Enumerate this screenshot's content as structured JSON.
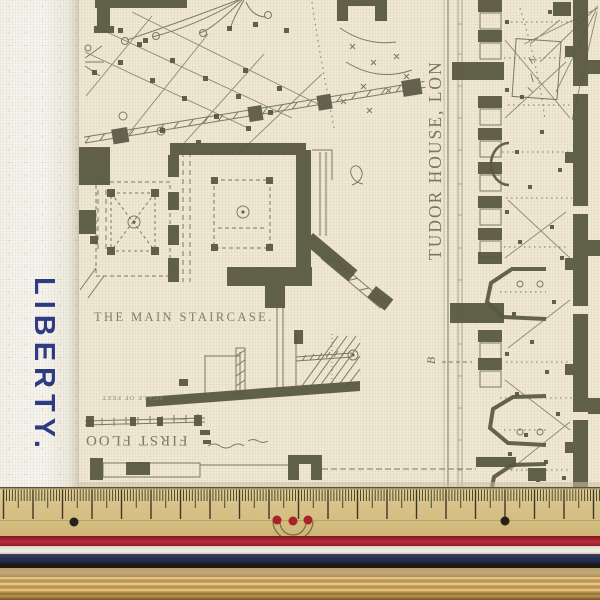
{
  "selvage": {
    "brand_text": "LIBERTY."
  },
  "print": {
    "labels": {
      "main_staircase": "THE MAIN STAIRCASE.",
      "tudor_house": "TUDOR HOUSE, LON",
      "first_floor": "FIRST FLOO",
      "scale_of_feet": "SCALE OF FEET",
      "plan_letter": "B"
    }
  },
  "colors": {
    "selvage-text": "#2c3a85",
    "selvage-bg": "#f7f5ef",
    "print-ink": "#6f7254",
    "print-ink-dark": "#585741",
    "print-bg": "#f0e8d4",
    "ruler-base": "#d8c48b",
    "ruler-tick": "#3e3726",
    "dot-black": "#26211a",
    "dot-red": "#a8222b",
    "stripe-red": "#a92330",
    "stripe-white": "#efe9dc",
    "stripe-navy": "#2a3050",
    "wood": "#cda45f"
  }
}
